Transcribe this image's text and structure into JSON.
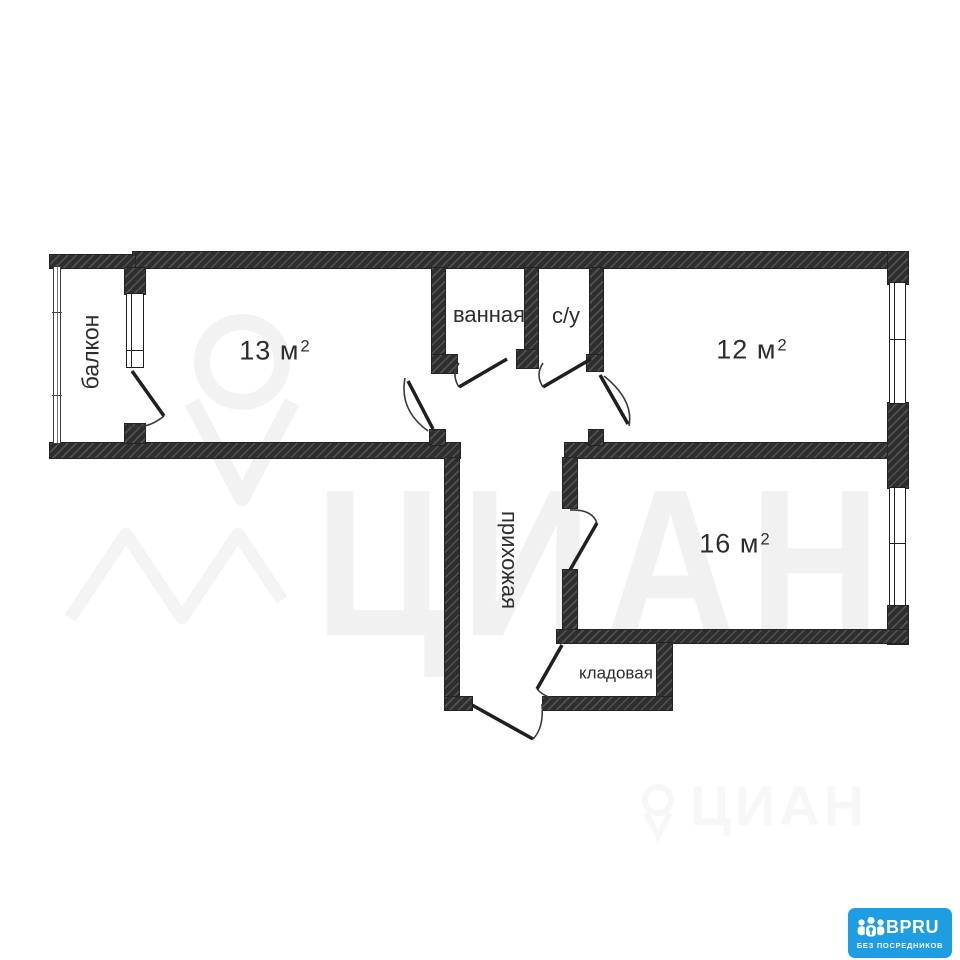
{
  "plan": {
    "rooms": {
      "balcony": {
        "name": "балкон"
      },
      "room13": {
        "area": "13 м",
        "sup": "2"
      },
      "bathroom": {
        "name": "ванная"
      },
      "wc": {
        "name": "с/у"
      },
      "room12": {
        "area": "12 м",
        "sup": "2"
      },
      "hallway": {
        "name": "прихожая"
      },
      "room16": {
        "area": "16 м",
        "sup": "2"
      },
      "storage": {
        "name": "кладовая"
      }
    }
  },
  "watermark": {
    "brand_large": "ЦИАН",
    "brand_small": "ЦИАН"
  },
  "badge": {
    "brand": "BPRU",
    "tagline": "БЕЗ ПОСРЕДНИКОВ",
    "background": "#1e9de3",
    "text_color": "#ffffff"
  },
  "colors": {
    "wall": "#2e2e2e",
    "background": "#ffffff",
    "line": "#222222"
  }
}
